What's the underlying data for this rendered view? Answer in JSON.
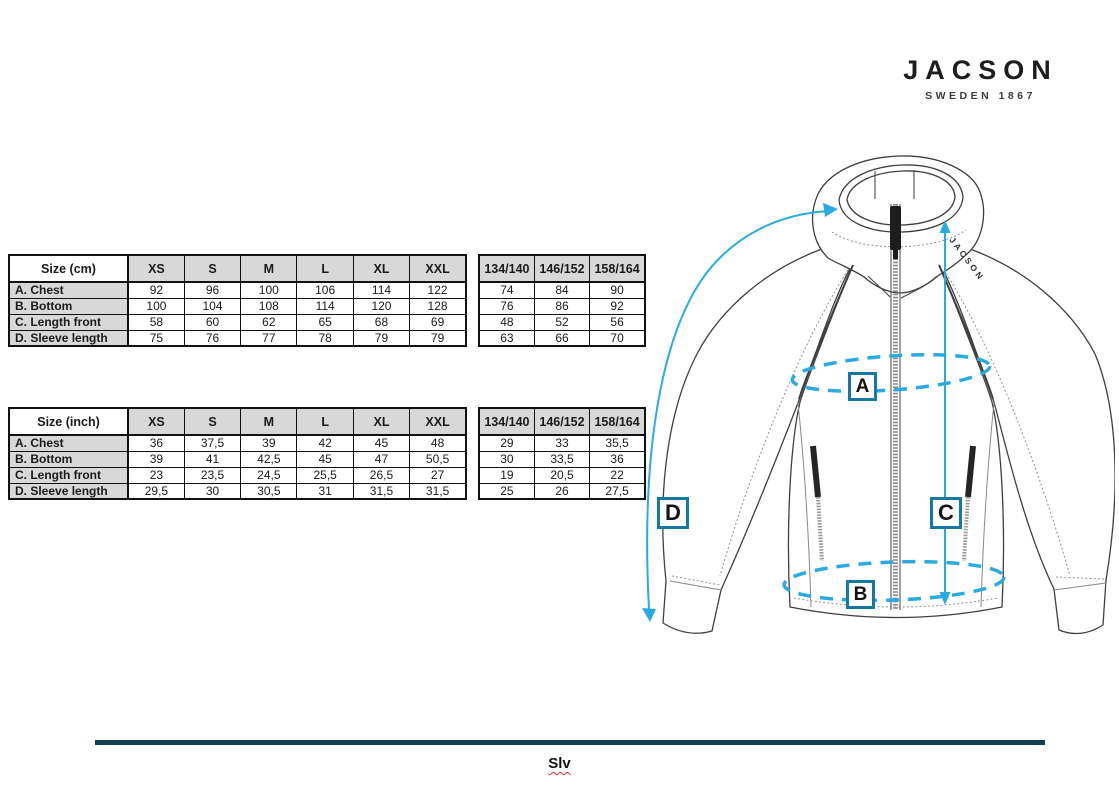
{
  "brand": {
    "name": "JACSON",
    "tagline": "SWEDEN 1867"
  },
  "size_tables": {
    "cm": {
      "main": {
        "corner_label": "Size (cm)",
        "columns": [
          "XS",
          "S",
          "M",
          "L",
          "XL",
          "XXL"
        ],
        "rows": [
          {
            "label": "A. Chest",
            "values": [
              "92",
              "96",
              "100",
              "106",
              "114",
              "122"
            ]
          },
          {
            "label": "B. Bottom",
            "values": [
              "100",
              "104",
              "108",
              "114",
              "120",
              "128"
            ]
          },
          {
            "label": "C. Length front",
            "values": [
              "58",
              "60",
              "62",
              "65",
              "68",
              "69"
            ]
          },
          {
            "label": "D. Sleeve length",
            "values": [
              "75",
              "76",
              "77",
              "78",
              "79",
              "79"
            ]
          }
        ]
      },
      "kids": {
        "columns": [
          "134/140",
          "146/152",
          "158/164"
        ],
        "rows": [
          {
            "values": [
              "74",
              "84",
              "90"
            ]
          },
          {
            "values": [
              "76",
              "86",
              "92"
            ]
          },
          {
            "values": [
              "48",
              "52",
              "56"
            ]
          },
          {
            "values": [
              "63",
              "66",
              "70"
            ]
          }
        ]
      }
    },
    "inch": {
      "main": {
        "corner_label": "Size (inch)",
        "columns": [
          "XS",
          "S",
          "M",
          "L",
          "XL",
          "XXL"
        ],
        "rows": [
          {
            "label": "A. Chest",
            "values": [
              "36",
              "37,5",
              "39",
              "42",
              "45",
              "48"
            ]
          },
          {
            "label": "B. Bottom",
            "values": [
              "39",
              "41",
              "42,5",
              "45",
              "47",
              "50,5"
            ]
          },
          {
            "label": "C. Length front",
            "values": [
              "23",
              "23,5",
              "24,5",
              "25,5",
              "26,5",
              "27"
            ]
          },
          {
            "label": "D. Sleeve length",
            "values": [
              "29,5",
              "30",
              "30,5",
              "31",
              "31,5",
              "31,5"
            ]
          }
        ]
      },
      "kids": {
        "columns": [
          "134/140",
          "146/152",
          "158/164"
        ],
        "rows": [
          {
            "values": [
              "29",
              "33",
              "35,5"
            ]
          },
          {
            "values": [
              "30",
              "33,5",
              "36"
            ]
          },
          {
            "values": [
              "19",
              "20,5",
              "22"
            ]
          },
          {
            "values": [
              "25",
              "26",
              "27,5"
            ]
          }
        ]
      }
    }
  },
  "diagram": {
    "garment_logo_text": "JACSON",
    "markers": [
      {
        "letter": "A"
      },
      {
        "letter": "B"
      },
      {
        "letter": "C"
      },
      {
        "letter": "D"
      }
    ]
  },
  "footer": {
    "caption": "Slv"
  },
  "colors": {
    "annotation_blue": "#29abe2",
    "marker_border": "#1778a6",
    "footer_rule": "#123f52",
    "table_header_bg": "#d8d8d8"
  }
}
